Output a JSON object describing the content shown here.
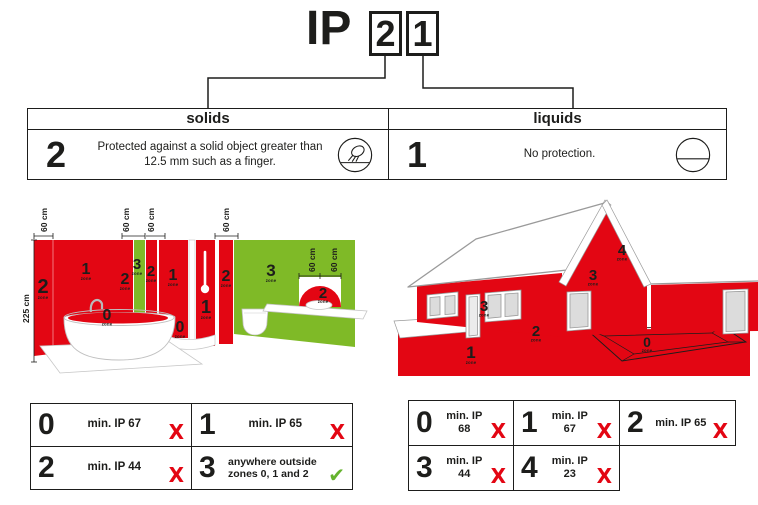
{
  "title": {
    "prefix": "IP",
    "solids_digit": "2",
    "liquids_digit": "1"
  },
  "rating_table": {
    "solids": {
      "header": "solids",
      "digit": "2",
      "description": "Protected against a solid object greater than 12.5 mm such as a finger.",
      "icon": "finger-protection-icon"
    },
    "liquids": {
      "header": "liquids",
      "digit": "1",
      "description": "No protection.",
      "icon": "no-protection-icon"
    }
  },
  "bathroom": {
    "height_label": "225 cm",
    "dim_labels": [
      "60 cm",
      "60 cm",
      "60 cm",
      "60 cm",
      "60 cm",
      "60 cm"
    ],
    "zone_word": "zone",
    "zones": [
      "2",
      "1",
      "0",
      "2",
      "3",
      "2",
      "1",
      "0",
      "1",
      "2",
      "3",
      "2"
    ]
  },
  "house": {
    "zone_word": "zone",
    "zones": [
      "4",
      "3",
      "3",
      "2",
      "1",
      "0"
    ]
  },
  "zone_rules_bathroom": {
    "cells": [
      {
        "zone": "0",
        "text": "min. IP 67",
        "mark": "cross"
      },
      {
        "zone": "1",
        "text": "min. IP 65",
        "mark": "cross"
      },
      {
        "zone": "2",
        "text": "min. IP 44",
        "mark": "cross"
      },
      {
        "zone": "3",
        "text": "anywhere outside zones 0, 1 and 2",
        "mark": "check"
      }
    ]
  },
  "zone_rules_house": {
    "cells": [
      {
        "zone": "0",
        "text": "min. IP 68",
        "mark": "cross"
      },
      {
        "zone": "1",
        "text": "min. IP 67",
        "mark": "cross"
      },
      {
        "zone": "2",
        "text": "min. IP 65",
        "mark": "cross"
      },
      {
        "zone": "3",
        "text": "min. IP 44",
        "mark": "cross"
      },
      {
        "zone": "4",
        "text": "min. IP 23",
        "mark": "cross"
      }
    ]
  },
  "marks": {
    "cross": {
      "glyph": "X",
      "color": "#e30613"
    },
    "check": {
      "glyph": "✔",
      "color": "#65b32e"
    }
  },
  "colors": {
    "red": "#e30613",
    "green": "#7fba27",
    "ink": "#1d1d1b",
    "check": "#65b32e"
  }
}
